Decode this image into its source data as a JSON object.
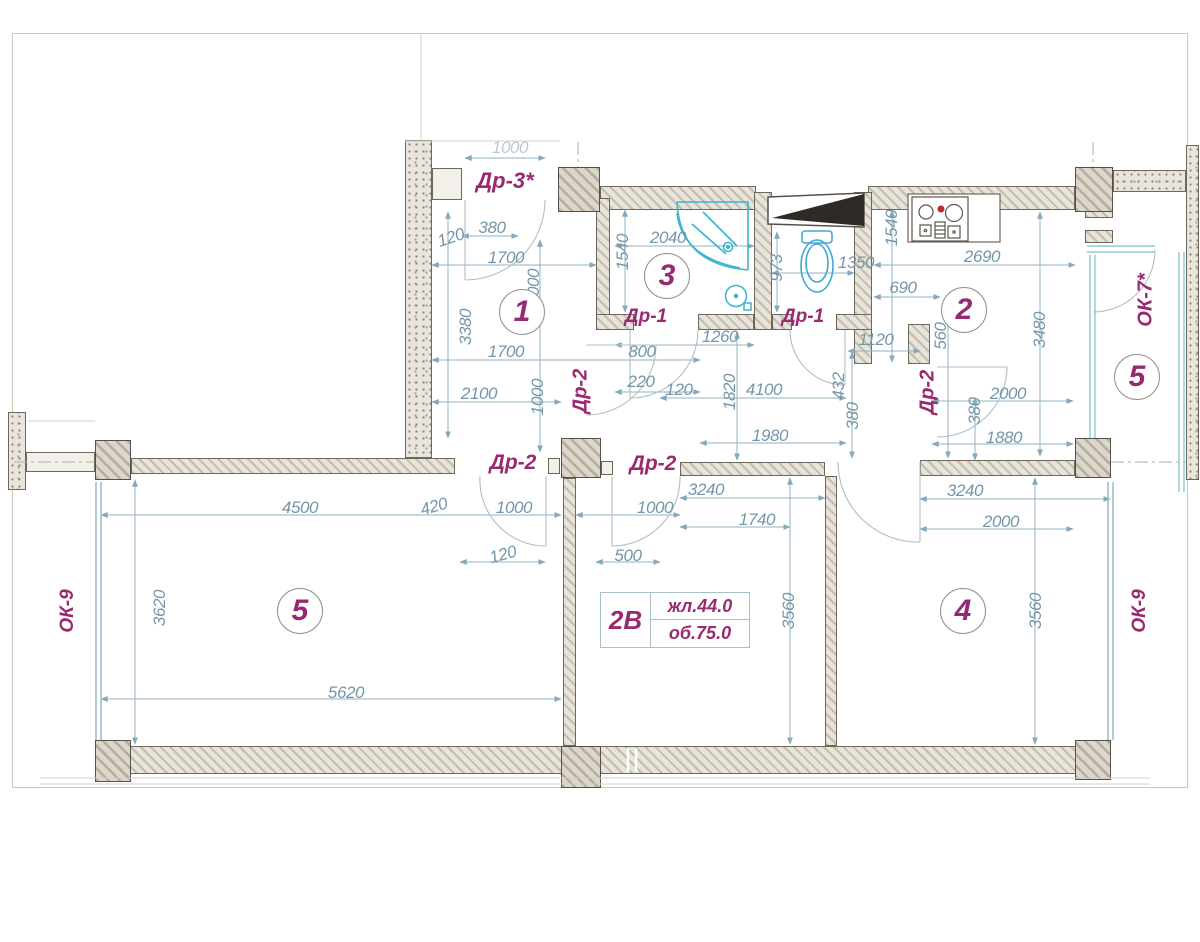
{
  "plan": {
    "colors": {
      "dimension_text": "#7496a8",
      "opening_text": "#9a2a70",
      "room_number": "#962a72",
      "fixture": "#3db4cd"
    },
    "apartment_label": {
      "type": "2В",
      "living": "жл.44.0",
      "total": "об.75.0"
    },
    "rooms": [
      {
        "number": "1",
        "x": 522,
        "y": 312
      },
      {
        "number": "3",
        "x": 667,
        "y": 276
      },
      {
        "number": "2",
        "x": 964,
        "y": 310
      },
      {
        "number": "5",
        "x": 1137,
        "y": 377
      },
      {
        "number": "5",
        "x": 300,
        "y": 611
      },
      {
        "number": "4",
        "x": 963,
        "y": 611
      }
    ],
    "openings": [
      {
        "label": "Др-3*",
        "x": 505,
        "y": 181,
        "rot": 0,
        "size": 22
      },
      {
        "label": "Др-1",
        "x": 646,
        "y": 317,
        "rot": 0,
        "size": 19
      },
      {
        "label": "Др-1",
        "x": 803,
        "y": 317,
        "rot": 0,
        "size": 19
      },
      {
        "label": "Др-2",
        "x": 581,
        "y": 391,
        "rot": -90,
        "size": 20
      },
      {
        "label": "Др-2",
        "x": 928,
        "y": 392,
        "rot": -90,
        "size": 20
      },
      {
        "label": "Др-2",
        "x": 513,
        "y": 463,
        "rot": 0,
        "size": 21
      },
      {
        "label": "Др-2",
        "x": 653,
        "y": 464,
        "rot": 0,
        "size": 21
      },
      {
        "label": "ОК-7*",
        "x": 1146,
        "y": 300,
        "rot": -90,
        "size": 20
      },
      {
        "label": "ОК-9",
        "x": 68,
        "y": 611,
        "rot": -90,
        "size": 19
      },
      {
        "label": "ОК-9",
        "x": 1140,
        "y": 611,
        "rot": -90,
        "size": 19
      }
    ],
    "dimensions": [
      {
        "text": "1000",
        "x": 510,
        "y": 148,
        "rot": 0,
        "faded": true
      },
      {
        "text": "380",
        "x": 492,
        "y": 228,
        "rot": 0
      },
      {
        "text": "120",
        "x": 451,
        "y": 238,
        "rot": -18
      },
      {
        "text": "1700",
        "x": 506,
        "y": 258,
        "rot": 0
      },
      {
        "text": "1540",
        "x": 623,
        "y": 252,
        "rot": -90
      },
      {
        "text": "2040",
        "x": 668,
        "y": 238,
        "rot": 0
      },
      {
        "text": "973",
        "x": 777,
        "y": 268,
        "rot": -90
      },
      {
        "text": "1350",
        "x": 856,
        "y": 263,
        "rot": 0
      },
      {
        "text": "690",
        "x": 903,
        "y": 288,
        "rot": 0
      },
      {
        "text": "1540",
        "x": 892,
        "y": 228,
        "rot": -90
      },
      {
        "text": "2690",
        "x": 982,
        "y": 257,
        "rot": 0
      },
      {
        "text": "3480",
        "x": 1040,
        "y": 330,
        "rot": -90
      },
      {
        "text": "560",
        "x": 941,
        "y": 336,
        "rot": -90
      },
      {
        "text": "1120",
        "x": 876,
        "y": 340,
        "rot": 0
      },
      {
        "text": "3380",
        "x": 466,
        "y": 327,
        "rot": -90
      },
      {
        "text": "2000",
        "x": 534,
        "y": 287,
        "rot": -90
      },
      {
        "text": "1700",
        "x": 506,
        "y": 352,
        "rot": 0
      },
      {
        "text": "2100",
        "x": 479,
        "y": 394,
        "rot": 0
      },
      {
        "text": "1000",
        "x": 538,
        "y": 397,
        "rot": -90
      },
      {
        "text": "800",
        "x": 642,
        "y": 352,
        "rot": 0
      },
      {
        "text": "220",
        "x": 641,
        "y": 382,
        "rot": 0
      },
      {
        "text": "120",
        "x": 679,
        "y": 390,
        "rot": 0
      },
      {
        "text": "1260",
        "x": 720,
        "y": 337,
        "rot": 0
      },
      {
        "text": "1820",
        "x": 730,
        "y": 392,
        "rot": -90
      },
      {
        "text": "4100",
        "x": 764,
        "y": 390,
        "rot": 0
      },
      {
        "text": "1980",
        "x": 770,
        "y": 436,
        "rot": 0
      },
      {
        "text": "432",
        "x": 839,
        "y": 386,
        "rot": -90
      },
      {
        "text": "380",
        "x": 853,
        "y": 416,
        "rot": -90
      },
      {
        "text": "380",
        "x": 975,
        "y": 411,
        "rot": -90
      },
      {
        "text": "2000",
        "x": 1008,
        "y": 394,
        "rot": 0
      },
      {
        "text": "1880",
        "x": 1004,
        "y": 438,
        "rot": 0
      },
      {
        "text": "4500",
        "x": 300,
        "y": 508,
        "rot": 0
      },
      {
        "text": "420",
        "x": 434,
        "y": 507,
        "rot": -15
      },
      {
        "text": "1000",
        "x": 514,
        "y": 508,
        "rot": 0
      },
      {
        "text": "120",
        "x": 503,
        "y": 555,
        "rot": -15
      },
      {
        "text": "1000",
        "x": 655,
        "y": 508,
        "rot": 0
      },
      {
        "text": "500",
        "x": 628,
        "y": 556,
        "rot": 0
      },
      {
        "text": "3240",
        "x": 706,
        "y": 490,
        "rot": 0
      },
      {
        "text": "1740",
        "x": 757,
        "y": 520,
        "rot": 0
      },
      {
        "text": "3240",
        "x": 965,
        "y": 491,
        "rot": 0
      },
      {
        "text": "2000",
        "x": 1001,
        "y": 522,
        "rot": 0
      },
      {
        "text": "3620",
        "x": 160,
        "y": 608,
        "rot": -90
      },
      {
        "text": "5620",
        "x": 346,
        "y": 693,
        "rot": 0
      },
      {
        "text": "3560",
        "x": 789,
        "y": 611,
        "rot": -90
      },
      {
        "text": "3560",
        "x": 1036,
        "y": 611,
        "rot": -90
      }
    ]
  }
}
